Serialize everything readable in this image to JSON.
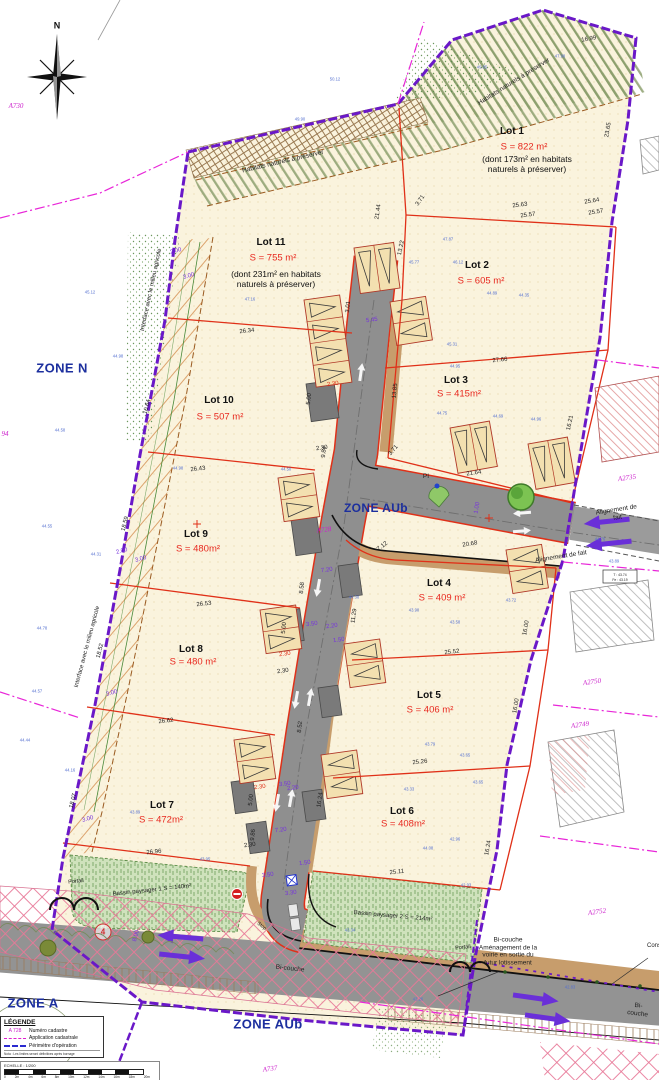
{
  "compass": {
    "label": "N"
  },
  "legend": {
    "title": "LÉGENDE",
    "items": [
      {
        "key": "A 728",
        "label": "Numéro cadastre"
      },
      {
        "key": "",
        "label": "Application cadastrale"
      },
      {
        "key": "",
        "label": "Périmètre d'opération"
      }
    ],
    "note": "Nota : Les limites seront définitives après bornage"
  },
  "scalebar": {
    "label": "ECHELLE : 1/200",
    "ticks": [
      "0",
      "2m",
      "4m",
      "6m",
      "8m",
      "10m",
      "12m",
      "14m",
      "16m",
      "18m",
      "20m"
    ]
  },
  "colors": {
    "perimeter": "#6a18c8",
    "cadastral": "#e826d8",
    "lot_line": "#e03018",
    "road": "#8f8f8f",
    "sidewalk": "#c79d6c",
    "zone_text": "#1c2f9e",
    "area_text": "#e8281e",
    "basin_green": "#cfe2bc",
    "arrow_purple": "#6a2fd8"
  },
  "label_layers": [
    {
      "name": "zone-label",
      "cls": "zone",
      "items": [
        {
          "t": "ZONE N",
          "x": 62,
          "y": 368
        },
        {
          "t": "ZONE AUb",
          "x": 376,
          "y": 508,
          "s": 12
        },
        {
          "t": "ZONE A",
          "x": 33,
          "y": 1003
        },
        {
          "t": "ZONE AUb",
          "x": 268,
          "y": 1024
        }
      ]
    },
    {
      "name": "parcel-label",
      "cls": "parcel",
      "items": [
        {
          "t": "A730",
          "x": 16,
          "y": 106
        },
        {
          "t": "94",
          "x": 5,
          "y": 434
        },
        {
          "t": "A728",
          "x": 324,
          "y": 530,
          "r": -8
        },
        {
          "t": "A2735",
          "x": 627,
          "y": 478,
          "r": -8
        },
        {
          "t": "A2750",
          "x": 592,
          "y": 682,
          "r": -8
        },
        {
          "t": "A2749",
          "x": 580,
          "y": 725,
          "r": -8
        },
        {
          "t": "A2752",
          "x": 597,
          "y": 912,
          "r": -8
        },
        {
          "t": "A737",
          "x": 270,
          "y": 1069,
          "r": -8
        }
      ]
    },
    {
      "name": "lot-name",
      "cls": "lotname",
      "items": [
        {
          "t": "Lot 1",
          "x": 512,
          "y": 132
        },
        {
          "t": "Lot 2",
          "x": 477,
          "y": 266
        },
        {
          "t": "Lot 3",
          "x": 456,
          "y": 381
        },
        {
          "t": "Lot 4",
          "x": 439,
          "y": 584
        },
        {
          "t": "Lot 5",
          "x": 429,
          "y": 696
        },
        {
          "t": "Lot 6",
          "x": 402,
          "y": 812
        },
        {
          "t": "Lot 7",
          "x": 162,
          "y": 806
        },
        {
          "t": "Lot 8",
          "x": 191,
          "y": 650
        },
        {
          "t": "Lot 9",
          "x": 196,
          "y": 535
        },
        {
          "t": "Lot 10",
          "x": 219,
          "y": 401
        },
        {
          "t": "Lot 11",
          "x": 271,
          "y": 243
        }
      ]
    },
    {
      "name": "lot-area",
      "cls": "lotarea",
      "items": [
        {
          "t": "S = 822 m²",
          "x": 524,
          "y": 147
        },
        {
          "t": "S = 605 m²",
          "x": 481,
          "y": 281
        },
        {
          "t": "S = 415m²",
          "x": 459,
          "y": 394
        },
        {
          "t": "S = 409 m²",
          "x": 442,
          "y": 598
        },
        {
          "t": "S = 406 m²",
          "x": 430,
          "y": 710
        },
        {
          "t": "S = 408m²",
          "x": 403,
          "y": 824
        },
        {
          "t": "S = 472m²",
          "x": 161,
          "y": 820
        },
        {
          "t": "S = 480 m²",
          "x": 193,
          "y": 662
        },
        {
          "t": "S = 480m²",
          "x": 198,
          "y": 549
        },
        {
          "t": "S = 507 m²",
          "x": 220,
          "y": 417
        },
        {
          "t": "S = 755 m²",
          "x": 273,
          "y": 258
        }
      ]
    },
    {
      "name": "lot-note",
      "cls": "lotnote",
      "items": [
        {
          "t": "(dont 173m² en habitats\nnaturels à préserver)",
          "x": 527,
          "y": 164,
          "w": 130
        },
        {
          "t": "(dont 231m² en habitats\nnaturels à préserver)",
          "x": 276,
          "y": 279,
          "w": 130
        }
      ]
    },
    {
      "name": "annotation",
      "cls": "ann",
      "items": [
        {
          "t": "Habitats naturels à préserver",
          "x": 283,
          "y": 162,
          "r": -13
        },
        {
          "t": "Habitats naturels à préserver",
          "x": 514,
          "y": 82,
          "r": -32
        },
        {
          "t": "Interface avec le milieu agricole",
          "x": 152,
          "y": 290,
          "r": -78,
          "s": 6
        },
        {
          "t": "Interface avec le milieu agricole",
          "x": 88,
          "y": 647,
          "r": -75,
          "s": 6
        },
        {
          "t": "Alignement de fait",
          "x": 617,
          "y": 514,
          "r": -9
        },
        {
          "t": "Alignement de fait",
          "x": 561,
          "y": 557,
          "r": -9
        },
        {
          "t": "Bi-couche\nAménagement de la\nvoirie en sortie du\nfutur lotissement",
          "x": 508,
          "y": 952,
          "w": 92
        },
        {
          "t": "Bi-couche",
          "x": 290,
          "y": 969,
          "r": 6
        },
        {
          "t": "Bi-couche",
          "x": 638,
          "y": 1010,
          "r": 7
        },
        {
          "t": "Conservation de la\nvoirie",
          "x": 672,
          "y": 950,
          "w": 72,
          "s": 6
        },
        {
          "t": "Portail",
          "x": 76,
          "y": 882,
          "s": 5.5,
          "r": -6
        },
        {
          "t": "Portail",
          "x": 463,
          "y": 948,
          "s": 5.5,
          "r": -6
        },
        {
          "t": "Stop",
          "x": 261,
          "y": 927,
          "r": 38,
          "s": 5
        },
        {
          "t": "PI",
          "x": 426,
          "y": 477
        },
        {
          "t": "Bassin paysager 1 S = 140m²",
          "x": 152,
          "y": 891,
          "r": -6,
          "s": 6
        },
        {
          "t": "Bassin paysager 2 S = 214m²",
          "x": 393,
          "y": 917,
          "r": 5,
          "s": 6
        }
      ]
    },
    {
      "name": "dimension-label",
      "cls": "dim",
      "items": [
        {
          "t": "25.63",
          "x": 520,
          "y": 206,
          "r": -7
        },
        {
          "t": "25.57",
          "x": 528,
          "y": 216,
          "r": -7
        },
        {
          "t": "25.64",
          "x": 592,
          "y": 202,
          "r": -9
        },
        {
          "t": "25.57",
          "x": 596,
          "y": 213,
          "r": -9
        },
        {
          "t": "27.66",
          "x": 500,
          "y": 361,
          "r": -6
        },
        {
          "t": "21.44",
          "x": 379,
          "y": 212,
          "r": -82
        },
        {
          "t": "13.22",
          "x": 402,
          "y": 248,
          "r": -78
        },
        {
          "t": "23.65",
          "x": 609,
          "y": 130,
          "r": -80
        },
        {
          "t": "16.99",
          "x": 589,
          "y": 40,
          "r": -10
        },
        {
          "t": "3.71",
          "x": 421,
          "y": 201,
          "r": -55
        },
        {
          "t": "13.85",
          "x": 396,
          "y": 391,
          "r": -84
        },
        {
          "t": "16.21",
          "x": 571,
          "y": 423,
          "r": -78
        },
        {
          "t": "21.64",
          "x": 474,
          "y": 474,
          "r": -8
        },
        {
          "t": "20.68",
          "x": 470,
          "y": 545,
          "r": -9
        },
        {
          "t": "26.34",
          "x": 247,
          "y": 332,
          "r": -6
        },
        {
          "t": "26.43",
          "x": 198,
          "y": 470,
          "r": -6
        },
        {
          "t": "26.53",
          "x": 204,
          "y": 605,
          "r": -6
        },
        {
          "t": "26.62",
          "x": 166,
          "y": 722,
          "r": -6
        },
        {
          "t": "26.96",
          "x": 154,
          "y": 853,
          "r": -6
        },
        {
          "t": "25.52",
          "x": 452,
          "y": 653,
          "r": -6
        },
        {
          "t": "25.26",
          "x": 420,
          "y": 763,
          "r": -6
        },
        {
          "t": "25.11",
          "x": 397,
          "y": 873,
          "r": -6
        },
        {
          "t": "16.00",
          "x": 527,
          "y": 628,
          "r": -80
        },
        {
          "t": "16.00",
          "x": 517,
          "y": 706,
          "r": -80
        },
        {
          "t": "16.24",
          "x": 489,
          "y": 848,
          "r": -80
        },
        {
          "t": "16.24",
          "x": 321,
          "y": 800,
          "r": -82
        },
        {
          "t": "18.59",
          "x": 126,
          "y": 524,
          "r": -76
        },
        {
          "t": "18.52",
          "x": 101,
          "y": 651,
          "r": -76
        },
        {
          "t": "18.07",
          "x": 74,
          "y": 801,
          "r": -76
        },
        {
          "t": "10.64",
          "x": 148,
          "y": 407,
          "r": -76
        },
        {
          "t": "9.84",
          "x": 325,
          "y": 452,
          "r": -84
        },
        {
          "t": "11.29",
          "x": 355,
          "y": 616,
          "r": -82
        },
        {
          "t": "8.58",
          "x": 303,
          "y": 588,
          "r": -84
        },
        {
          "t": "8.52",
          "x": 301,
          "y": 727,
          "r": -84
        },
        {
          "t": "9.86",
          "x": 254,
          "y": 835,
          "r": -84
        },
        {
          "t": "3.71",
          "x": 394,
          "y": 451,
          "r": -50
        },
        {
          "t": "7.12",
          "x": 383,
          "y": 547,
          "r": -38
        },
        {
          "t": "3.01",
          "x": 349,
          "y": 307,
          "r": -84
        },
        {
          "t": "5.00",
          "x": 310,
          "y": 399,
          "r": -84
        },
        {
          "t": "2.30",
          "x": 322,
          "y": 449,
          "r": -8
        },
        {
          "t": "5.00",
          "x": 285,
          "y": 628,
          "r": -84
        },
        {
          "t": "2.30",
          "x": 283,
          "y": 672,
          "r": -8
        },
        {
          "t": "5.00",
          "x": 252,
          "y": 800,
          "r": -84
        },
        {
          "t": "2.30",
          "x": 250,
          "y": 846,
          "r": -8
        }
      ]
    },
    {
      "name": "road-dimension",
      "cls": "rdim",
      "items": [
        {
          "t": "5.45",
          "x": 372,
          "y": 321,
          "r": -8
        },
        {
          "t": "7.20",
          "x": 327,
          "y": 571,
          "r": -8
        },
        {
          "t": "7.20",
          "x": 281,
          "y": 831,
          "r": -8
        },
        {
          "t": "3.50",
          "x": 312,
          "y": 625,
          "r": -8
        },
        {
          "t": "3.50",
          "x": 285,
          "y": 785,
          "r": -8
        },
        {
          "t": "3.50",
          "x": 268,
          "y": 876,
          "r": -8
        },
        {
          "t": "2.20",
          "x": 332,
          "y": 627,
          "r": -8
        },
        {
          "t": "2.20",
          "x": 293,
          "y": 789,
          "r": -8
        },
        {
          "t": "1.50",
          "x": 339,
          "y": 641,
          "r": -8
        },
        {
          "t": "1.50",
          "x": 305,
          "y": 864,
          "r": -8
        },
        {
          "t": "3.30",
          "x": 291,
          "y": 894,
          "r": -8
        },
        {
          "t": "1.00",
          "x": 478,
          "y": 508,
          "r": -80
        },
        {
          "t": "3.00",
          "x": 189,
          "y": 277,
          "r": -15
        },
        {
          "t": "3.00",
          "x": 141,
          "y": 560,
          "r": -15
        },
        {
          "t": "3.00",
          "x": 112,
          "y": 694,
          "r": -15
        },
        {
          "t": "3.00",
          "x": 88,
          "y": 820,
          "r": -15
        },
        {
          "t": "2.00",
          "x": 176,
          "y": 252,
          "r": -15
        },
        {
          "t": "2.00",
          "x": 122,
          "y": 552,
          "r": -15
        },
        {
          "t": "8.00",
          "x": 137,
          "y": 936,
          "r": -75
        }
      ]
    },
    {
      "name": "red-dimension",
      "cls": "reddim",
      "items": [
        {
          "t": "2.30",
          "x": 333,
          "y": 385,
          "r": -8
        },
        {
          "t": "2.30",
          "x": 285,
          "y": 655,
          "r": -8
        },
        {
          "t": "2.30",
          "x": 260,
          "y": 788,
          "r": -8
        }
      ]
    },
    {
      "name": "spot-elevation",
      "cls": "elev",
      "items": [
        {
          "t": "49.85",
          "x": 482,
          "y": 68
        },
        {
          "t": "47.98",
          "x": 560,
          "y": 57
        },
        {
          "t": "50.12",
          "x": 335,
          "y": 80
        },
        {
          "t": "49.90",
          "x": 300,
          "y": 120
        },
        {
          "t": "45.12",
          "x": 90,
          "y": 293
        },
        {
          "t": "44.98",
          "x": 118,
          "y": 357
        },
        {
          "t": "44.98",
          "x": 178,
          "y": 469
        },
        {
          "t": "44.58",
          "x": 60,
          "y": 431
        },
        {
          "t": "44.55",
          "x": 47,
          "y": 527
        },
        {
          "t": "44.78",
          "x": 42,
          "y": 629
        },
        {
          "t": "44.57",
          "x": 37,
          "y": 692
        },
        {
          "t": "44.44",
          "x": 25,
          "y": 741
        },
        {
          "t": "44.16",
          "x": 70,
          "y": 771
        },
        {
          "t": "43.89",
          "x": 135,
          "y": 813
        },
        {
          "t": "43.95",
          "x": 205,
          "y": 860
        },
        {
          "t": "47.16",
          "x": 250,
          "y": 300
        },
        {
          "t": "47.87",
          "x": 448,
          "y": 240
        },
        {
          "t": "44.89",
          "x": 492,
          "y": 294
        },
        {
          "t": "44.35",
          "x": 524,
          "y": 296
        },
        {
          "t": "46.12",
          "x": 458,
          "y": 263
        },
        {
          "t": "45.77",
          "x": 414,
          "y": 263
        },
        {
          "t": "45.31",
          "x": 452,
          "y": 345
        },
        {
          "t": "44.95",
          "x": 455,
          "y": 367
        },
        {
          "t": "44.75",
          "x": 442,
          "y": 414
        },
        {
          "t": "44.69",
          "x": 498,
          "y": 417
        },
        {
          "t": "44.96",
          "x": 536,
          "y": 420
        },
        {
          "t": "44.38",
          "x": 354,
          "y": 598
        },
        {
          "t": "43.90",
          "x": 414,
          "y": 611
        },
        {
          "t": "43.58",
          "x": 455,
          "y": 623
        },
        {
          "t": "43.72",
          "x": 511,
          "y": 601
        },
        {
          "t": "43.79",
          "x": 430,
          "y": 745
        },
        {
          "t": "43.65",
          "x": 465,
          "y": 756
        },
        {
          "t": "43.33",
          "x": 409,
          "y": 790
        },
        {
          "t": "43.65",
          "x": 478,
          "y": 783
        },
        {
          "t": "42.96",
          "x": 455,
          "y": 840
        },
        {
          "t": "44.08",
          "x": 428,
          "y": 849
        },
        {
          "t": "42.93",
          "x": 466,
          "y": 886
        },
        {
          "t": "43.34",
          "x": 350,
          "y": 931
        },
        {
          "t": "43.26",
          "x": 418,
          "y": 1000
        },
        {
          "t": "42.83",
          "x": 570,
          "y": 988
        },
        {
          "t": "44.76",
          "x": 600,
          "y": 540
        },
        {
          "t": "43.89",
          "x": 614,
          "y": 562
        },
        {
          "t": "44.31",
          "x": 96,
          "y": 555
        },
        {
          "t": "44.50",
          "x": 286,
          "y": 470
        }
      ]
    },
    {
      "name": "compass-label",
      "cls": "compassN",
      "items": [
        {
          "t": "N",
          "x": 57,
          "y": 26
        }
      ]
    },
    {
      "name": "marker-label",
      "cls": "marker4",
      "items": [
        {
          "t": "4",
          "x": 103,
          "y": 932
        }
      ]
    },
    {
      "name": "level-value",
      "cls": "levels",
      "items": [
        {
          "t": "T : 43.74",
          "x": 620,
          "y": 575
        },
        {
          "t": "Fe : 43.19",
          "x": 620,
          "y": 580
        }
      ]
    }
  ]
}
